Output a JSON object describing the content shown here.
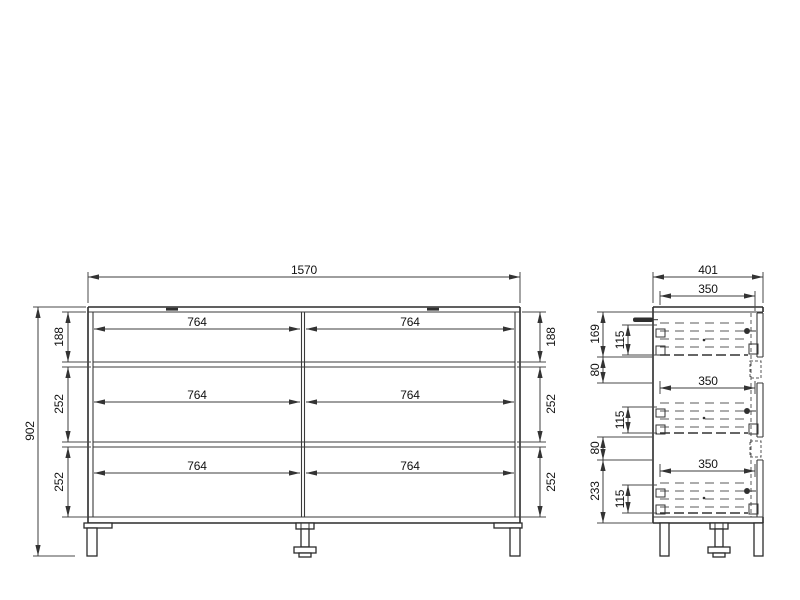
{
  "front_view": {
    "overall_width": "1570",
    "overall_height": "902",
    "row_heights_left": [
      "188",
      "252",
      "252"
    ],
    "row_heights_right": [
      "188",
      "252",
      "252"
    ],
    "drawer_widths": [
      "764",
      "764",
      "764",
      "764",
      "764",
      "764"
    ]
  },
  "side_view": {
    "overall_depth": "401",
    "drawer_depths": [
      "350",
      "350",
      "350"
    ],
    "top_section_height": "169",
    "gap_heights": [
      "80",
      "80"
    ],
    "bottom_section_height": "233",
    "drawer_side_heights": [
      "115",
      "115",
      "115"
    ]
  },
  "colors": {
    "background": "#ffffff",
    "object_line": "#2b2b2b",
    "dimension_line": "#3d3d3d",
    "text": "#121212"
  }
}
